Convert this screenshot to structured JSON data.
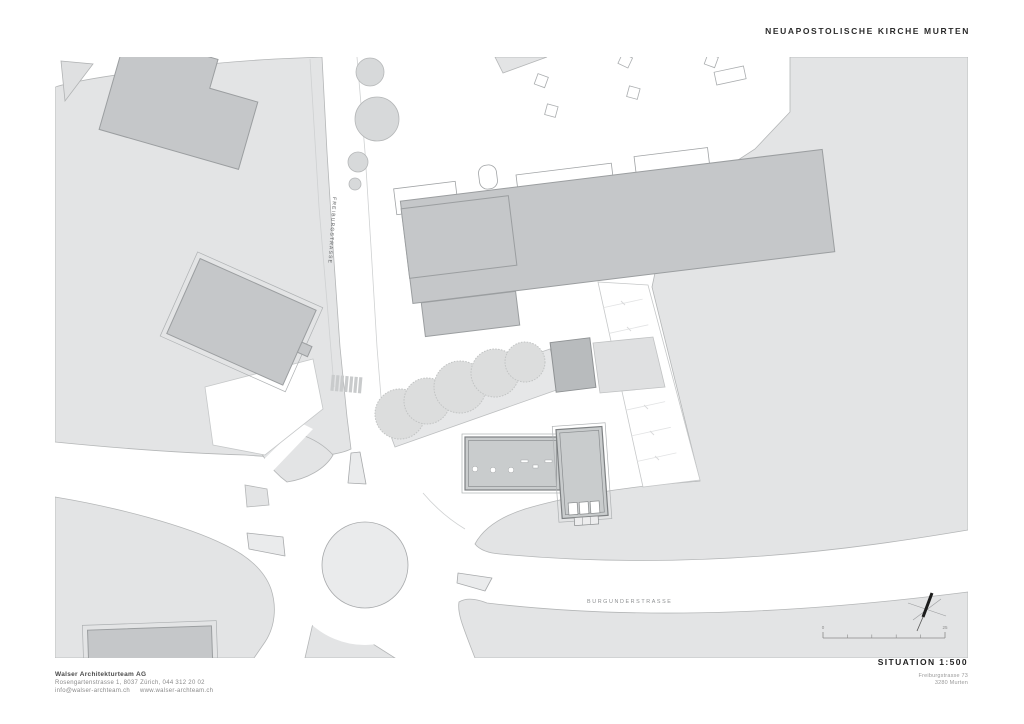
{
  "header": {
    "title": "NEUAPOSTOLISCHE KIRCHE MURTEN"
  },
  "plan": {
    "street_labels": {
      "freiburgstrasse": "FREIBURGSTRASSE",
      "burgunderstrasse": "BURGUNDERSTRASSE"
    },
    "scale_bar": {
      "start_label": "0",
      "end_label": "25"
    },
    "colors": {
      "terrain": "#e3e4e5",
      "road": "#ffffff",
      "building_fill": "#c5c7c9",
      "building_stroke": "#9b9ea0",
      "new_building_fill": "#c9cccd",
      "new_building_stroke": "#7d8082",
      "tree_fill": "#dcdddd",
      "island_fill": "#eaebec",
      "title_text": "#2b2b2b",
      "muted_text": "#8a8a8a"
    }
  },
  "footer": {
    "architect": {
      "name": "Walser Architekturteam AG",
      "address": "Rosengartenstrasse 1, 8037 Zürich,  044 312 20 02",
      "email": "info@walser-archteam.ch",
      "website": "www.walser-archteam.ch"
    },
    "drawing": {
      "title": "SITUATION 1:500",
      "project_address_line1": "Freiburgstrasse 73",
      "project_address_line2": "3280 Murten"
    }
  }
}
